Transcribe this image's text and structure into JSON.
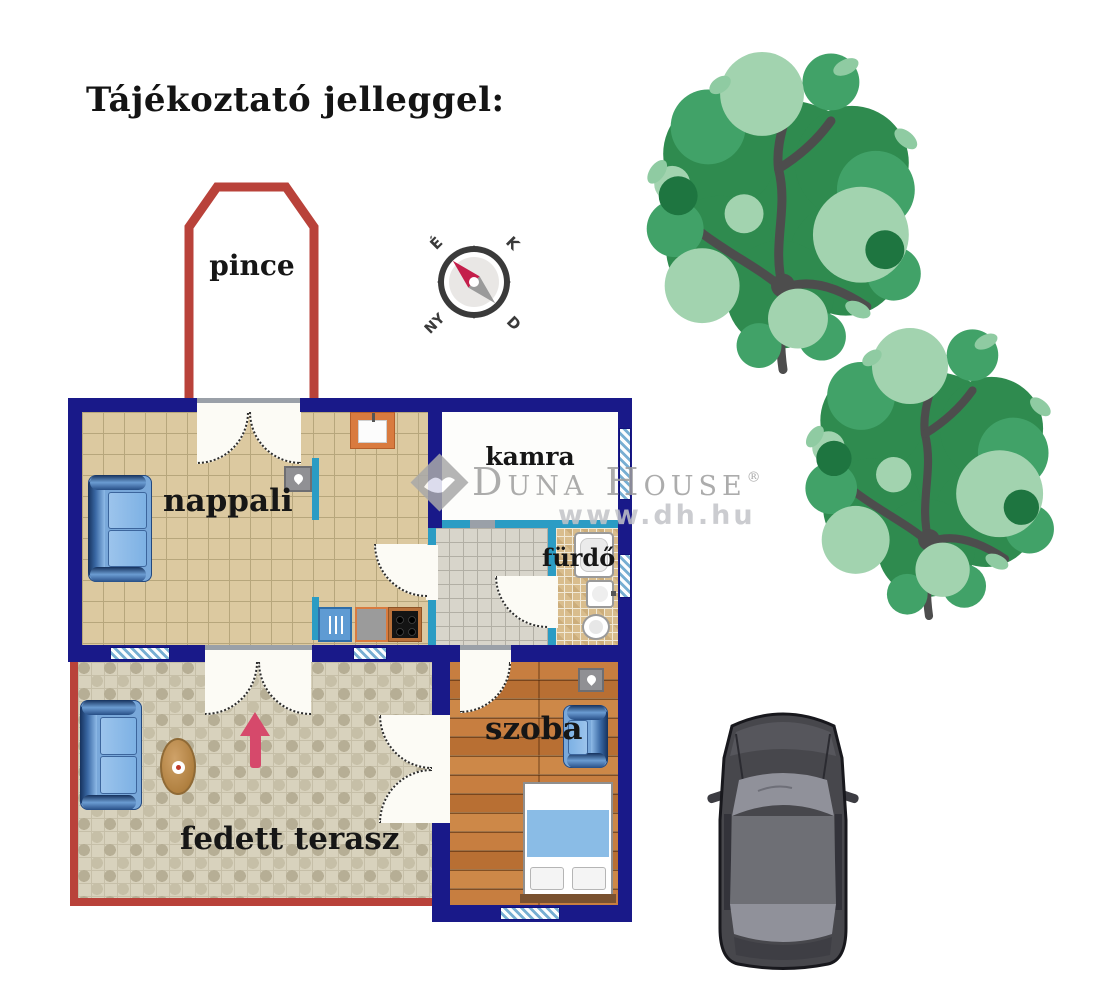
{
  "title": "Tájékoztató jelleggel:",
  "compass": {
    "n": "É",
    "e": "K",
    "w": "NY",
    "s": "D"
  },
  "rooms": {
    "pince": "pince",
    "nappali": "nappali",
    "kamra": "kamra",
    "furdo": "fürdő",
    "szoba": "szoba",
    "terasz": "fedett terasz"
  },
  "watermark": {
    "brand": "Duna House",
    "reg": "®",
    "url": "www.dh.hu"
  },
  "icons": {
    "compass": "compass-rose-icon",
    "fireplace": "flame-icon",
    "kitchen_unit": "utensils-icon",
    "stove": "stove-burners-icon",
    "sink": "kitchen-sink-icon",
    "bathtub": "bathtub-icon",
    "washbasin": "washbasin-icon",
    "toilet": "toilet-icon",
    "sofa": "sofa-icon",
    "armchair": "armchair-icon",
    "bed": "double-bed-icon",
    "table": "oval-table-icon",
    "entrance_arrow": "entrance-arrow-icon",
    "tree": "tree-icon",
    "car": "car-icon",
    "logo": "duna-house-diamond-logo"
  },
  "colors": {
    "wall": "#191989",
    "interior_wall": "#2b9cc4",
    "outline_red": "#b9423a",
    "floor_tile": "#dcca9f",
    "floor_wood": "#c0793c",
    "floor_terrace": "#d8d2bd",
    "arrow": "#d6496b",
    "tree_green": "#318c52",
    "watermark_gray": "#9e9e9e",
    "car_gray": "#46464a",
    "furniture_blue": "#79a8da"
  }
}
